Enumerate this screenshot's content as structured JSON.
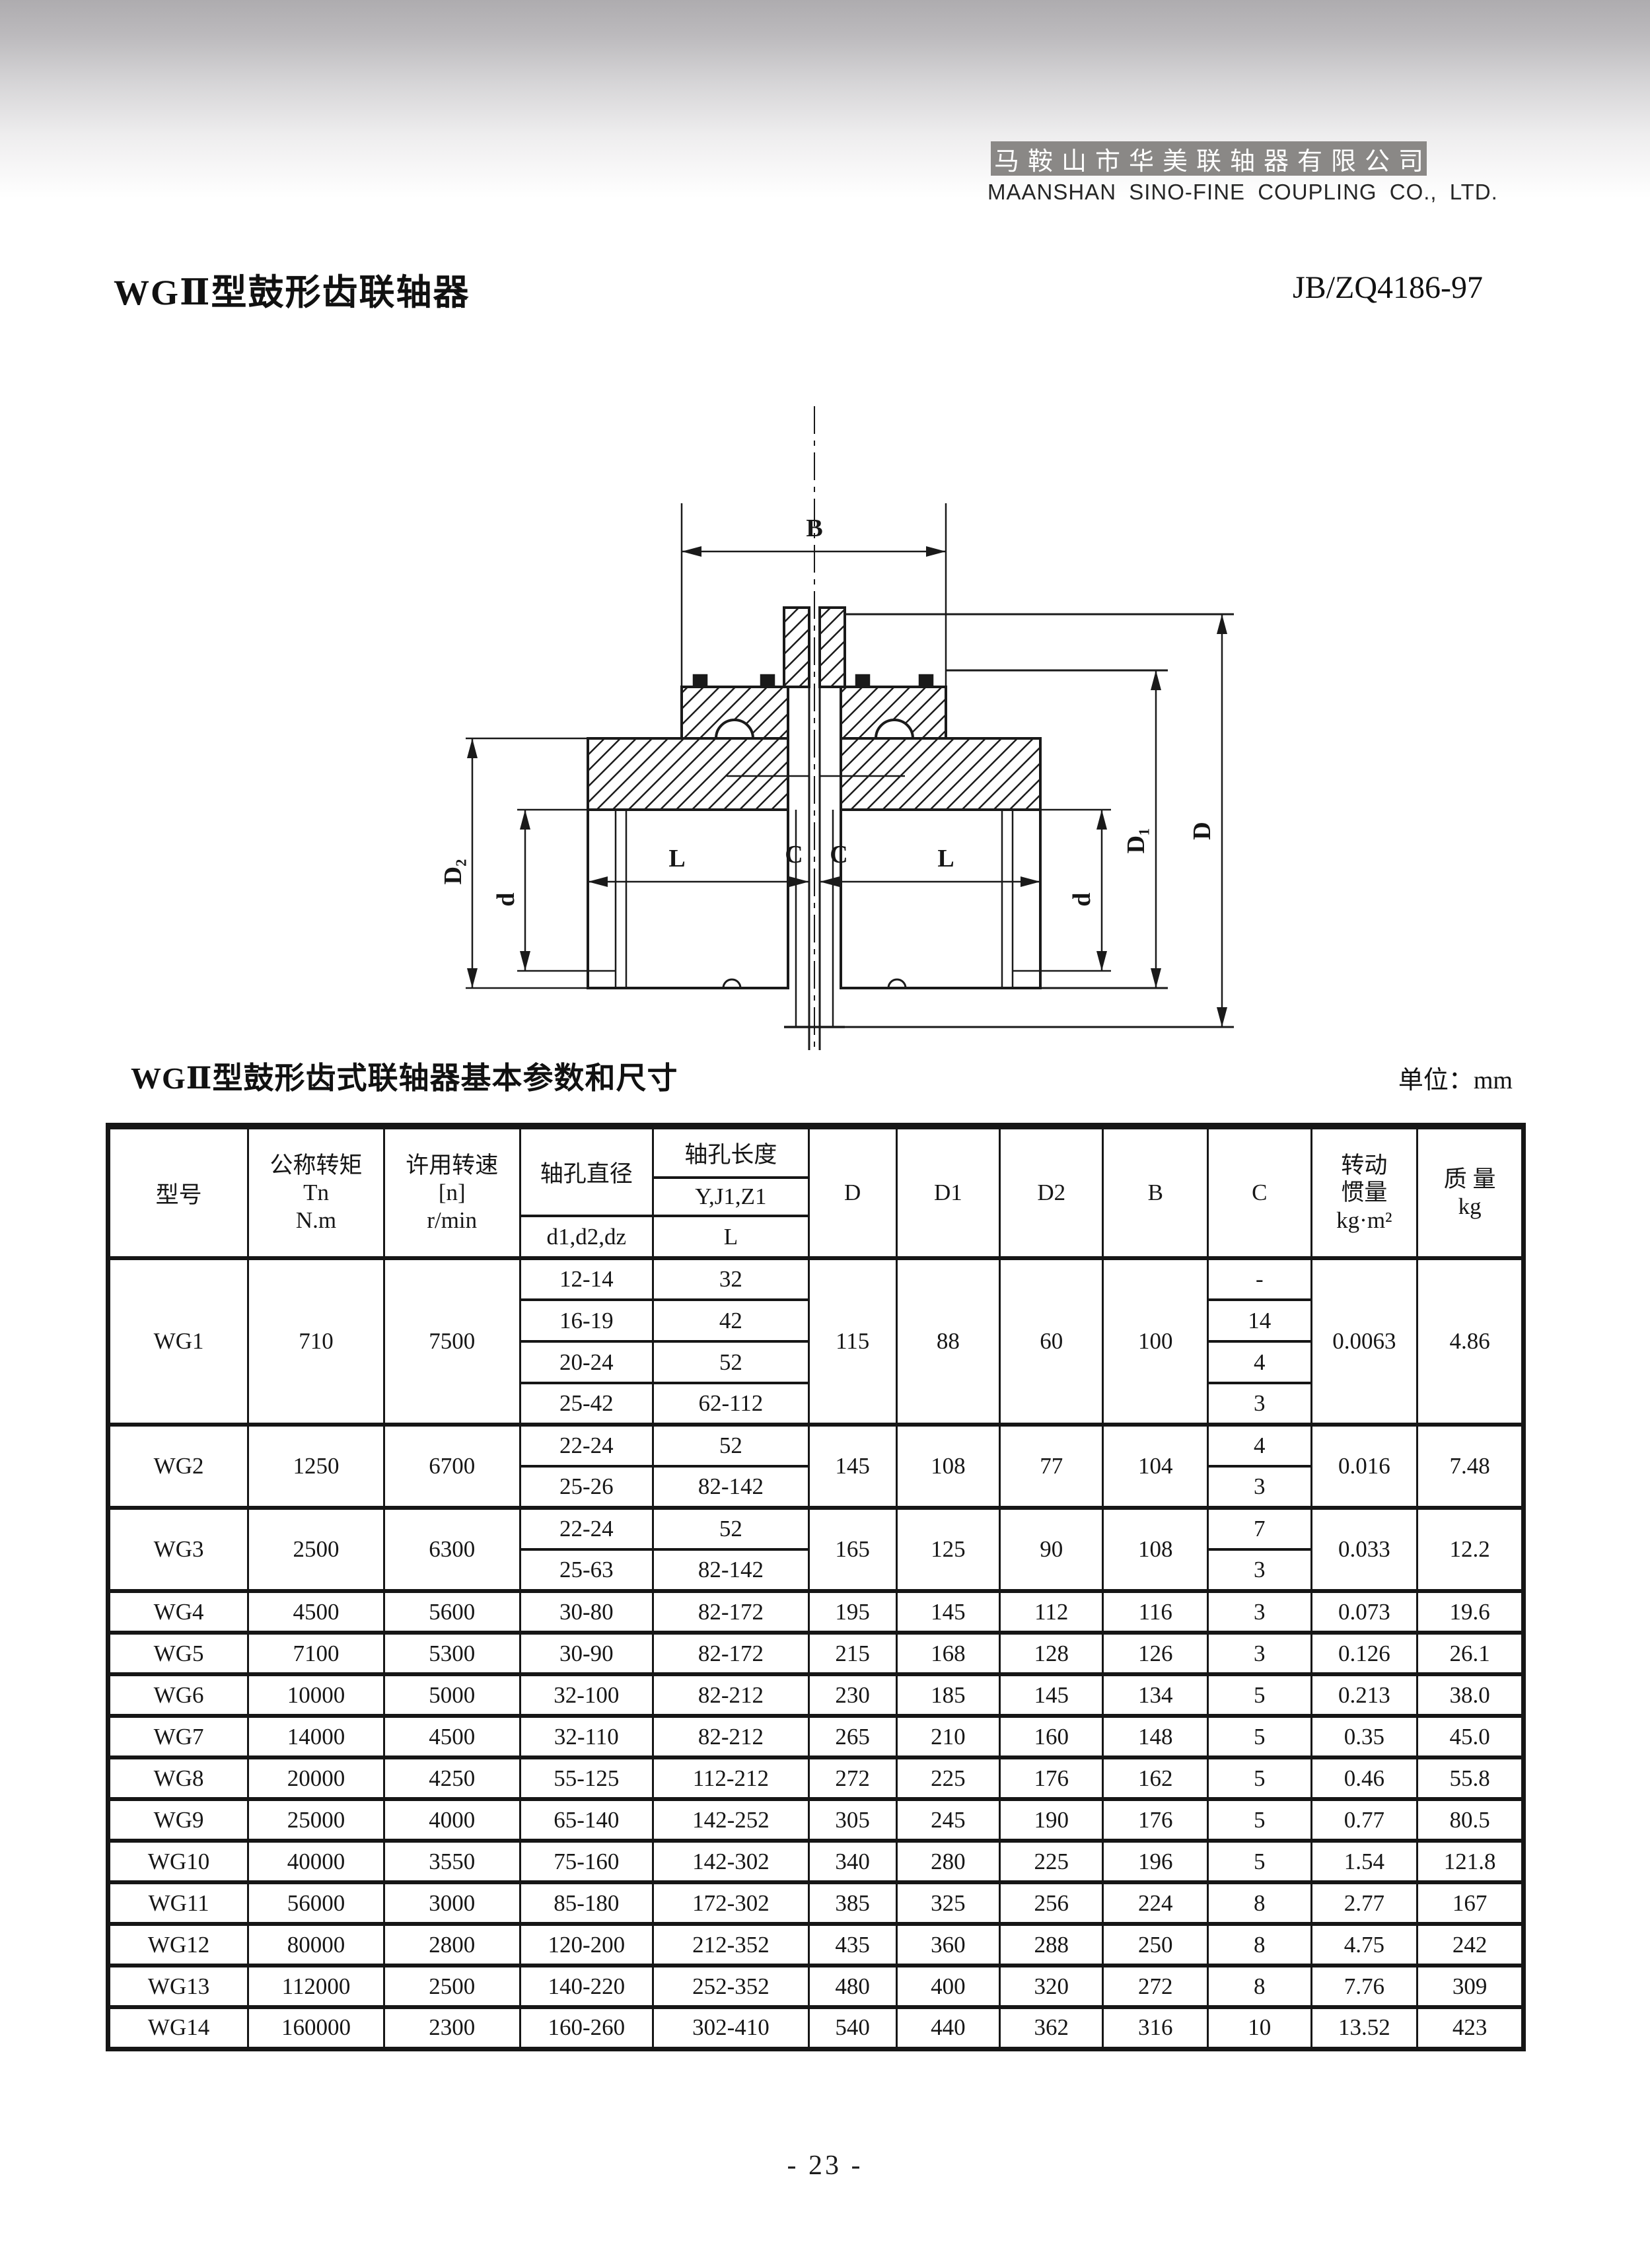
{
  "header": {
    "company_cn": "马鞍山市华美联轴器有限公司",
    "company_en": "MAANSHAN SINO-FINE COUPLING CO., LTD.",
    "band_color": "#8a8886"
  },
  "title": {
    "product": "WGⅡ型鼓形齿联轴器",
    "standard": "JB/ZQ4186-97"
  },
  "drawing": {
    "labels": {
      "B": "B",
      "L_left": "L",
      "C_left": "C",
      "C_right": "C",
      "L_right": "L",
      "D2": "D₂",
      "d_left": "d",
      "d_right": "d",
      "D1": "D₁",
      "D": "D"
    }
  },
  "table": {
    "title": "WGⅡ型鼓形齿式联轴器基本参数和尺寸",
    "unit": "单位：mm",
    "headers": {
      "model": "型号",
      "torque": {
        "line1": "公称转矩",
        "line2": "Tn",
        "line3": "N.m"
      },
      "speed": {
        "line1": "许用转速",
        "line2": "[n]",
        "line3": "r/min"
      },
      "bore": {
        "title": "轴孔直径",
        "sub": "d1,d2,dz"
      },
      "length": {
        "title": "轴孔长度",
        "sub1": "Y,J1,Z1",
        "sub2": "L"
      },
      "D": "D",
      "D1": "D1",
      "D2": "D2",
      "B": "B",
      "C": "C",
      "inertia": {
        "line1": "转动",
        "line2": "惯量",
        "unit": "kg·m²"
      },
      "mass": {
        "line1": "质 量",
        "unit": "kg"
      }
    },
    "groups": [
      {
        "model": "WG1",
        "torque": "710",
        "speed": "7500",
        "D": "115",
        "D1": "88",
        "D2": "60",
        "B": "100",
        "inertia": "0.0063",
        "mass": "4.86",
        "rows": [
          [
            "12-14",
            "32",
            "-"
          ],
          [
            "16-19",
            "42",
            "14"
          ],
          [
            "20-24",
            "52",
            "4"
          ],
          [
            "25-42",
            "62-112",
            "3"
          ]
        ]
      },
      {
        "model": "WG2",
        "torque": "1250",
        "speed": "6700",
        "D": "145",
        "D1": "108",
        "D2": "77",
        "B": "104",
        "inertia": "0.016",
        "mass": "7.48",
        "rows": [
          [
            "22-24",
            "52",
            "4"
          ],
          [
            "25-26",
            "82-142",
            "3"
          ]
        ]
      },
      {
        "model": "WG3",
        "torque": "2500",
        "speed": "6300",
        "D": "165",
        "D1": "125",
        "D2": "90",
        "B": "108",
        "inertia": "0.033",
        "mass": "12.2",
        "rows": [
          [
            "22-24",
            "52",
            "7"
          ],
          [
            "25-63",
            "82-142",
            "3"
          ]
        ]
      },
      {
        "model": "WG4",
        "torque": "4500",
        "speed": "5600",
        "D": "195",
        "D1": "145",
        "D2": "112",
        "B": "116",
        "inertia": "0.073",
        "mass": "19.6",
        "rows": [
          [
            "30-80",
            "82-172",
            "3"
          ]
        ]
      },
      {
        "model": "WG5",
        "torque": "7100",
        "speed": "5300",
        "D": "215",
        "D1": "168",
        "D2": "128",
        "B": "126",
        "inertia": "0.126",
        "mass": "26.1",
        "rows": [
          [
            "30-90",
            "82-172",
            "3"
          ]
        ]
      },
      {
        "model": "WG6",
        "torque": "10000",
        "speed": "5000",
        "D": "230",
        "D1": "185",
        "D2": "145",
        "B": "134",
        "inertia": "0.213",
        "mass": "38.0",
        "rows": [
          [
            "32-100",
            "82-212",
            "5"
          ]
        ]
      },
      {
        "model": "WG7",
        "torque": "14000",
        "speed": "4500",
        "D": "265",
        "D1": "210",
        "D2": "160",
        "B": "148",
        "inertia": "0.35",
        "mass": "45.0",
        "rows": [
          [
            "32-110",
            "82-212",
            "5"
          ]
        ]
      },
      {
        "model": "WG8",
        "torque": "20000",
        "speed": "4250",
        "D": "272",
        "D1": "225",
        "D2": "176",
        "B": "162",
        "inertia": "0.46",
        "mass": "55.8",
        "rows": [
          [
            "55-125",
            "112-212",
            "5"
          ]
        ]
      },
      {
        "model": "WG9",
        "torque": "25000",
        "speed": "4000",
        "D": "305",
        "D1": "245",
        "D2": "190",
        "B": "176",
        "inertia": "0.77",
        "mass": "80.5",
        "rows": [
          [
            "65-140",
            "142-252",
            "5"
          ]
        ]
      },
      {
        "model": "WG10",
        "torque": "40000",
        "speed": "3550",
        "D": "340",
        "D1": "280",
        "D2": "225",
        "B": "196",
        "inertia": "1.54",
        "mass": "121.8",
        "rows": [
          [
            "75-160",
            "142-302",
            "5"
          ]
        ]
      },
      {
        "model": "WG11",
        "torque": "56000",
        "speed": "3000",
        "D": "385",
        "D1": "325",
        "D2": "256",
        "B": "224",
        "inertia": "2.77",
        "mass": "167",
        "rows": [
          [
            "85-180",
            "172-302",
            "8"
          ]
        ]
      },
      {
        "model": "WG12",
        "torque": "80000",
        "speed": "2800",
        "D": "435",
        "D1": "360",
        "D2": "288",
        "B": "250",
        "inertia": "4.75",
        "mass": "242",
        "rows": [
          [
            "120-200",
            "212-352",
            "8"
          ]
        ]
      },
      {
        "model": "WG13",
        "torque": "112000",
        "speed": "2500",
        "D": "480",
        "D1": "400",
        "D2": "320",
        "B": "272",
        "inertia": "7.76",
        "mass": "309",
        "rows": [
          [
            "140-220",
            "252-352",
            "8"
          ]
        ]
      },
      {
        "model": "WG14",
        "torque": "160000",
        "speed": "2300",
        "D": "540",
        "D1": "440",
        "D2": "362",
        "B": "316",
        "inertia": "13.52",
        "mass": "423",
        "rows": [
          [
            "160-260",
            "302-410",
            "10"
          ]
        ]
      }
    ]
  },
  "page": {
    "page_number": "- 23 -"
  }
}
